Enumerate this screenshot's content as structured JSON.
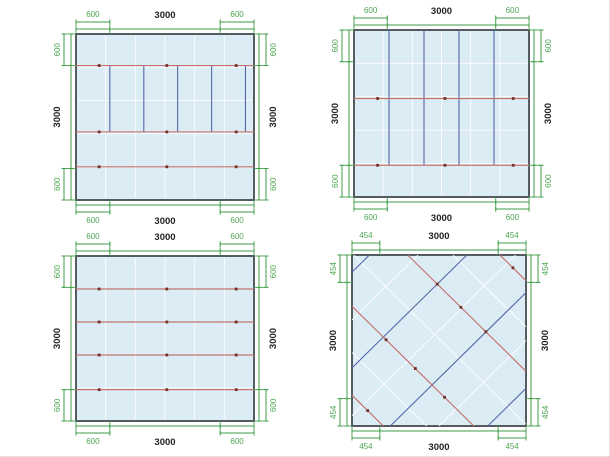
{
  "page": {
    "background": "#ffffff"
  },
  "colors": {
    "dimension_line": "#3f9e49",
    "dimension_text": "#4ea553",
    "overall_text": "#222222",
    "panel_border": "#545c62",
    "panel_fill": "#dcecf5",
    "panel_grid": "rgba(255,255,255,0.85)",
    "red_line": "#c4736f",
    "red_dot": "#733127",
    "blue_line": "#5468a7"
  },
  "panels": [
    {
      "position": "top-left",
      "corner_fraction": 0.19,
      "labels": {
        "top": [
          "600",
          "3000",
          "600"
        ],
        "bottom": [
          "600",
          "3000",
          "600"
        ],
        "left": [
          "600",
          "3000",
          "600"
        ],
        "right": [
          "600",
          "3000",
          "600"
        ]
      },
      "content": {
        "red_h": [
          0.19,
          0.59,
          0.8
        ],
        "red_dots_x": [
          0.13,
          0.51,
          0.9
        ],
        "blue_v": {
          "xs": [
            0.19,
            0.381,
            0.571,
            0.762,
            0.952
          ],
          "y1": 0.19,
          "y2": 0.59
        }
      }
    },
    {
      "position": "top-right",
      "corner_fraction": 0.19,
      "labels": {
        "top": [
          "600",
          "3000",
          "600"
        ],
        "bottom": [
          "600",
          "3000",
          "600"
        ],
        "left": [
          "600",
          "3000",
          "600"
        ],
        "right": [
          "600",
          "3000",
          "600"
        ]
      },
      "content": {
        "red_h": [
          0.41,
          0.81
        ],
        "red_dots_x": [
          0.135,
          0.52,
          0.91
        ],
        "blue_v": {
          "xs": [
            0.2,
            0.4,
            0.6,
            0.8
          ],
          "y1": 0.0,
          "y2": 0.81
        }
      }
    },
    {
      "position": "bottom-left",
      "corner_fraction": 0.19,
      "labels": {
        "top": [
          "600",
          "3000",
          "600"
        ],
        "bottom": [
          "600",
          "3000",
          "600"
        ],
        "left": [
          "600",
          "3000",
          "600"
        ],
        "right": [
          "600",
          "3000",
          "600"
        ]
      },
      "content": {
        "red_h": [
          0.2,
          0.4,
          0.6,
          0.81
        ],
        "red_dots_x": [
          0.13,
          0.51,
          0.9
        ]
      }
    },
    {
      "position": "bottom-right",
      "corner_fraction": 0.16,
      "labels": {
        "top": [
          "454",
          "3000",
          "454"
        ],
        "bottom": [
          "454",
          "3000",
          "454"
        ],
        "left": [
          "454",
          "3000",
          "454"
        ],
        "right": [
          "454",
          "3000",
          "454"
        ]
      },
      "content": {
        "red_diag": [
          {
            "d": -0.82,
            "dots": [
              0.5
            ]
          },
          {
            "d": -0.3,
            "dots": [
              0.28,
              0.52,
              0.76
            ]
          },
          {
            "d": 0.32,
            "dots": [
              0.25,
              0.45,
              0.66
            ]
          },
          {
            "d": 0.85,
            "dots": [
              0.5
            ]
          }
        ],
        "blue_diag": [
          0.1,
          0.66,
          1.22,
          1.78
        ],
        "faint_diag_slash": [
          0.38,
          0.94,
          1.5
        ],
        "faint_diag_backslash": [
          -0.57,
          0.01,
          0.58
        ]
      }
    }
  ]
}
